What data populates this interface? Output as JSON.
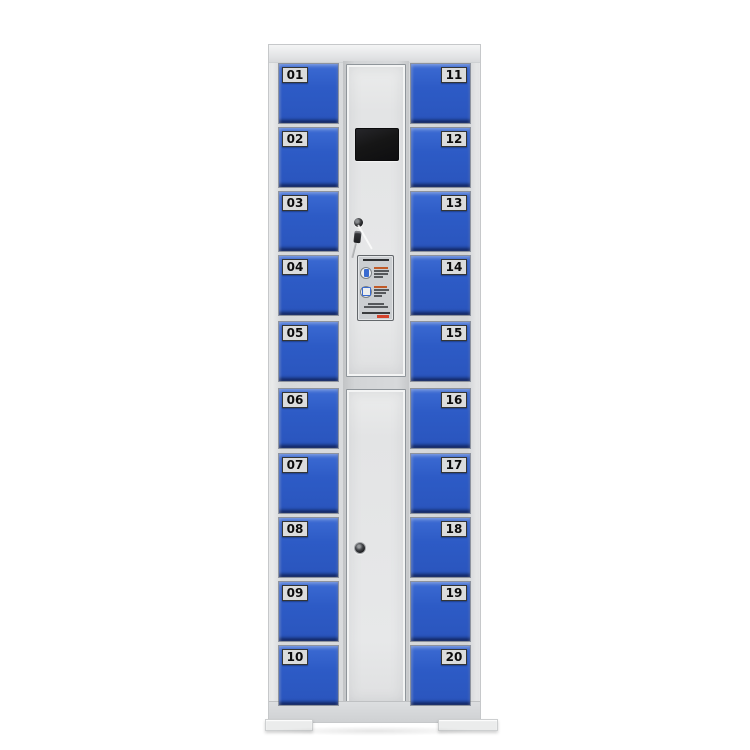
{
  "scene": {
    "description": "Product photo of a 20-compartment blue and grey smart electronic storage locker cabinet on a white background",
    "background_color": "#ffffff"
  },
  "doors": {
    "left": [
      "01",
      "02",
      "03",
      "04",
      "05",
      "06",
      "07",
      "08",
      "09",
      "10"
    ],
    "right": [
      "11",
      "12",
      "13",
      "14",
      "15",
      "16",
      "17",
      "18",
      "19",
      "20"
    ]
  },
  "control_panel": {
    "screen": {
      "icon": "control-screen",
      "state": "off",
      "color": "#161616"
    },
    "upper_lock": {
      "icon": "key-lock-icon",
      "keys_inserted": "keys hanging from lock"
    },
    "lower_lock": {
      "icon": "key-lock-icon"
    },
    "instruction_sticker": {
      "icon_steps": [
        "phone-icon",
        "scan-code-icon"
      ],
      "accent": "warning-accent",
      "text_legibility": "printed Chinese usage instructions, illegible at photo resolution"
    }
  },
  "colors": {
    "door_blue": "#2d5bc6",
    "cabinet_gray": "#d8dadc",
    "screen_black": "#161616",
    "warning_red": "#d4432c",
    "label_bg": "#dbdcdc"
  }
}
